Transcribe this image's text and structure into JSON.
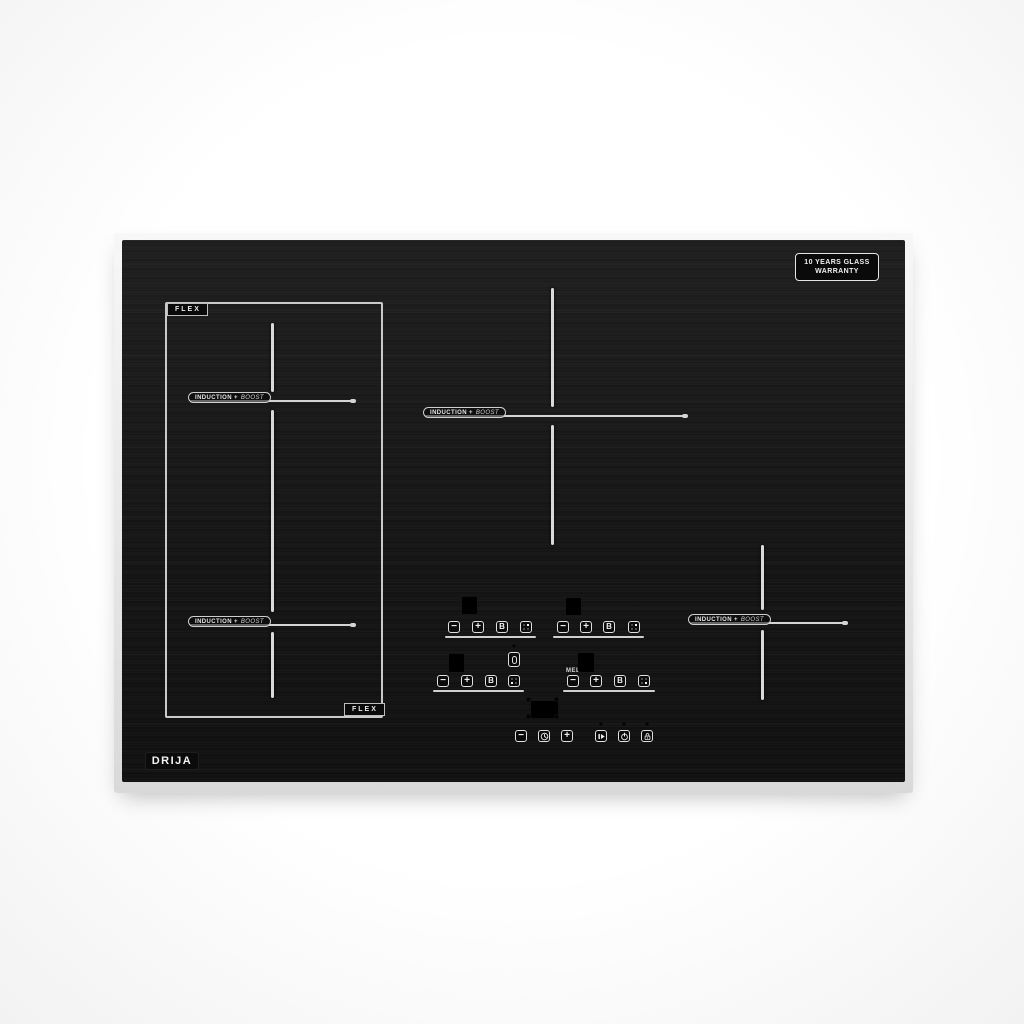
{
  "brand": {
    "name": "DRIJA"
  },
  "badge": {
    "line1": "10 YEARS GLASS",
    "line2": "WARRANTY"
  },
  "zones": {
    "flex_label": "FLEX",
    "induction_prefix": "INDUCTION +",
    "boost_word": "BOOST",
    "melt_label": "MELT"
  },
  "controls": {
    "minus": "−",
    "plus": "+",
    "boost": "B"
  },
  "icons": {
    "timer": "clock-icon",
    "pause": "pause-play-icon",
    "power": "power-icon",
    "lock": "lock-icon",
    "level": "power-level-dots-icon",
    "bridge": "bridge-zone-icon"
  },
  "colors": {
    "glass": "#161616",
    "frame": "#e9e9e9",
    "zone_lines": "#d9d9d9",
    "text": "#e8e8e8"
  }
}
